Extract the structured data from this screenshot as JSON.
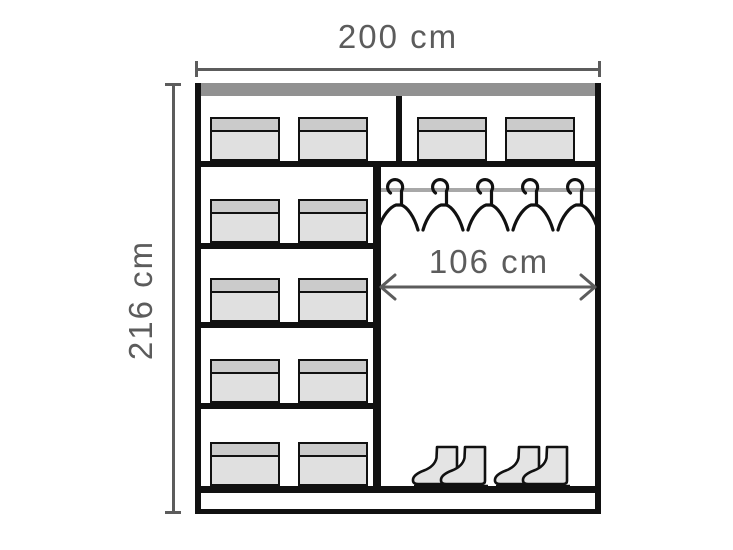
{
  "colors": {
    "bg": "#ffffff",
    "outline": "#111111",
    "dim": "#5c5c5c",
    "topbar": "#919191",
    "rod": "#a8a8a8",
    "boxbody": "#e0e0e0",
    "boxlid": "#cbcbcb",
    "bootfill": "#e4e4e4"
  },
  "diagram": {
    "labels": {
      "overall_width": "200 cm",
      "overall_height": "216 cm",
      "hanging_section_width": "106 cm"
    },
    "features": {
      "left_shelf_rows": 5,
      "boxes_per_left_row": 2,
      "top_shelf_boxes_right": 2,
      "hangers": 5,
      "boot_pairs": 2
    }
  }
}
